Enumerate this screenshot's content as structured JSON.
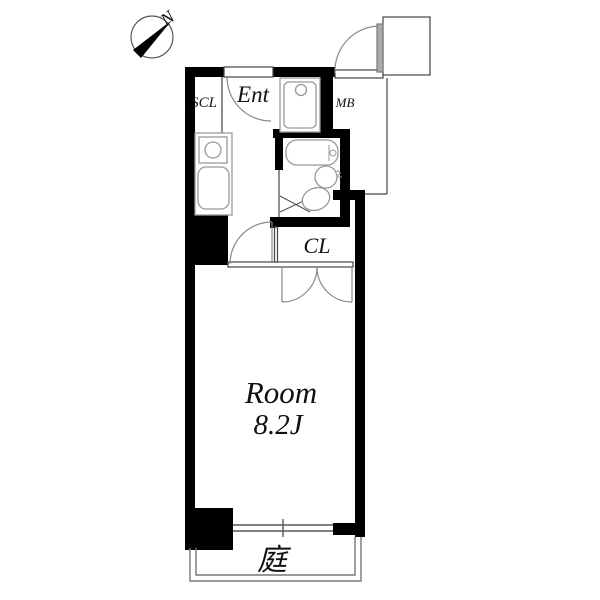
{
  "title": "apartment-floor-plan",
  "compass": {
    "label": "N"
  },
  "rooms": {
    "entrance": {
      "label": "Ent"
    },
    "shoe_closet": {
      "label": "SCL"
    },
    "meter_box": {
      "label": "MB"
    },
    "closet": {
      "label": "CL"
    },
    "main_room": {
      "name": "Room",
      "size": "8.2J"
    },
    "garden": {
      "label": "庭"
    }
  },
  "colors": {
    "wall": "#000000",
    "thin_line": "#444444",
    "fixture_line": "#999999",
    "door_line": "#888888",
    "door_leaf": "#aaaaaa",
    "background": "#ffffff"
  }
}
